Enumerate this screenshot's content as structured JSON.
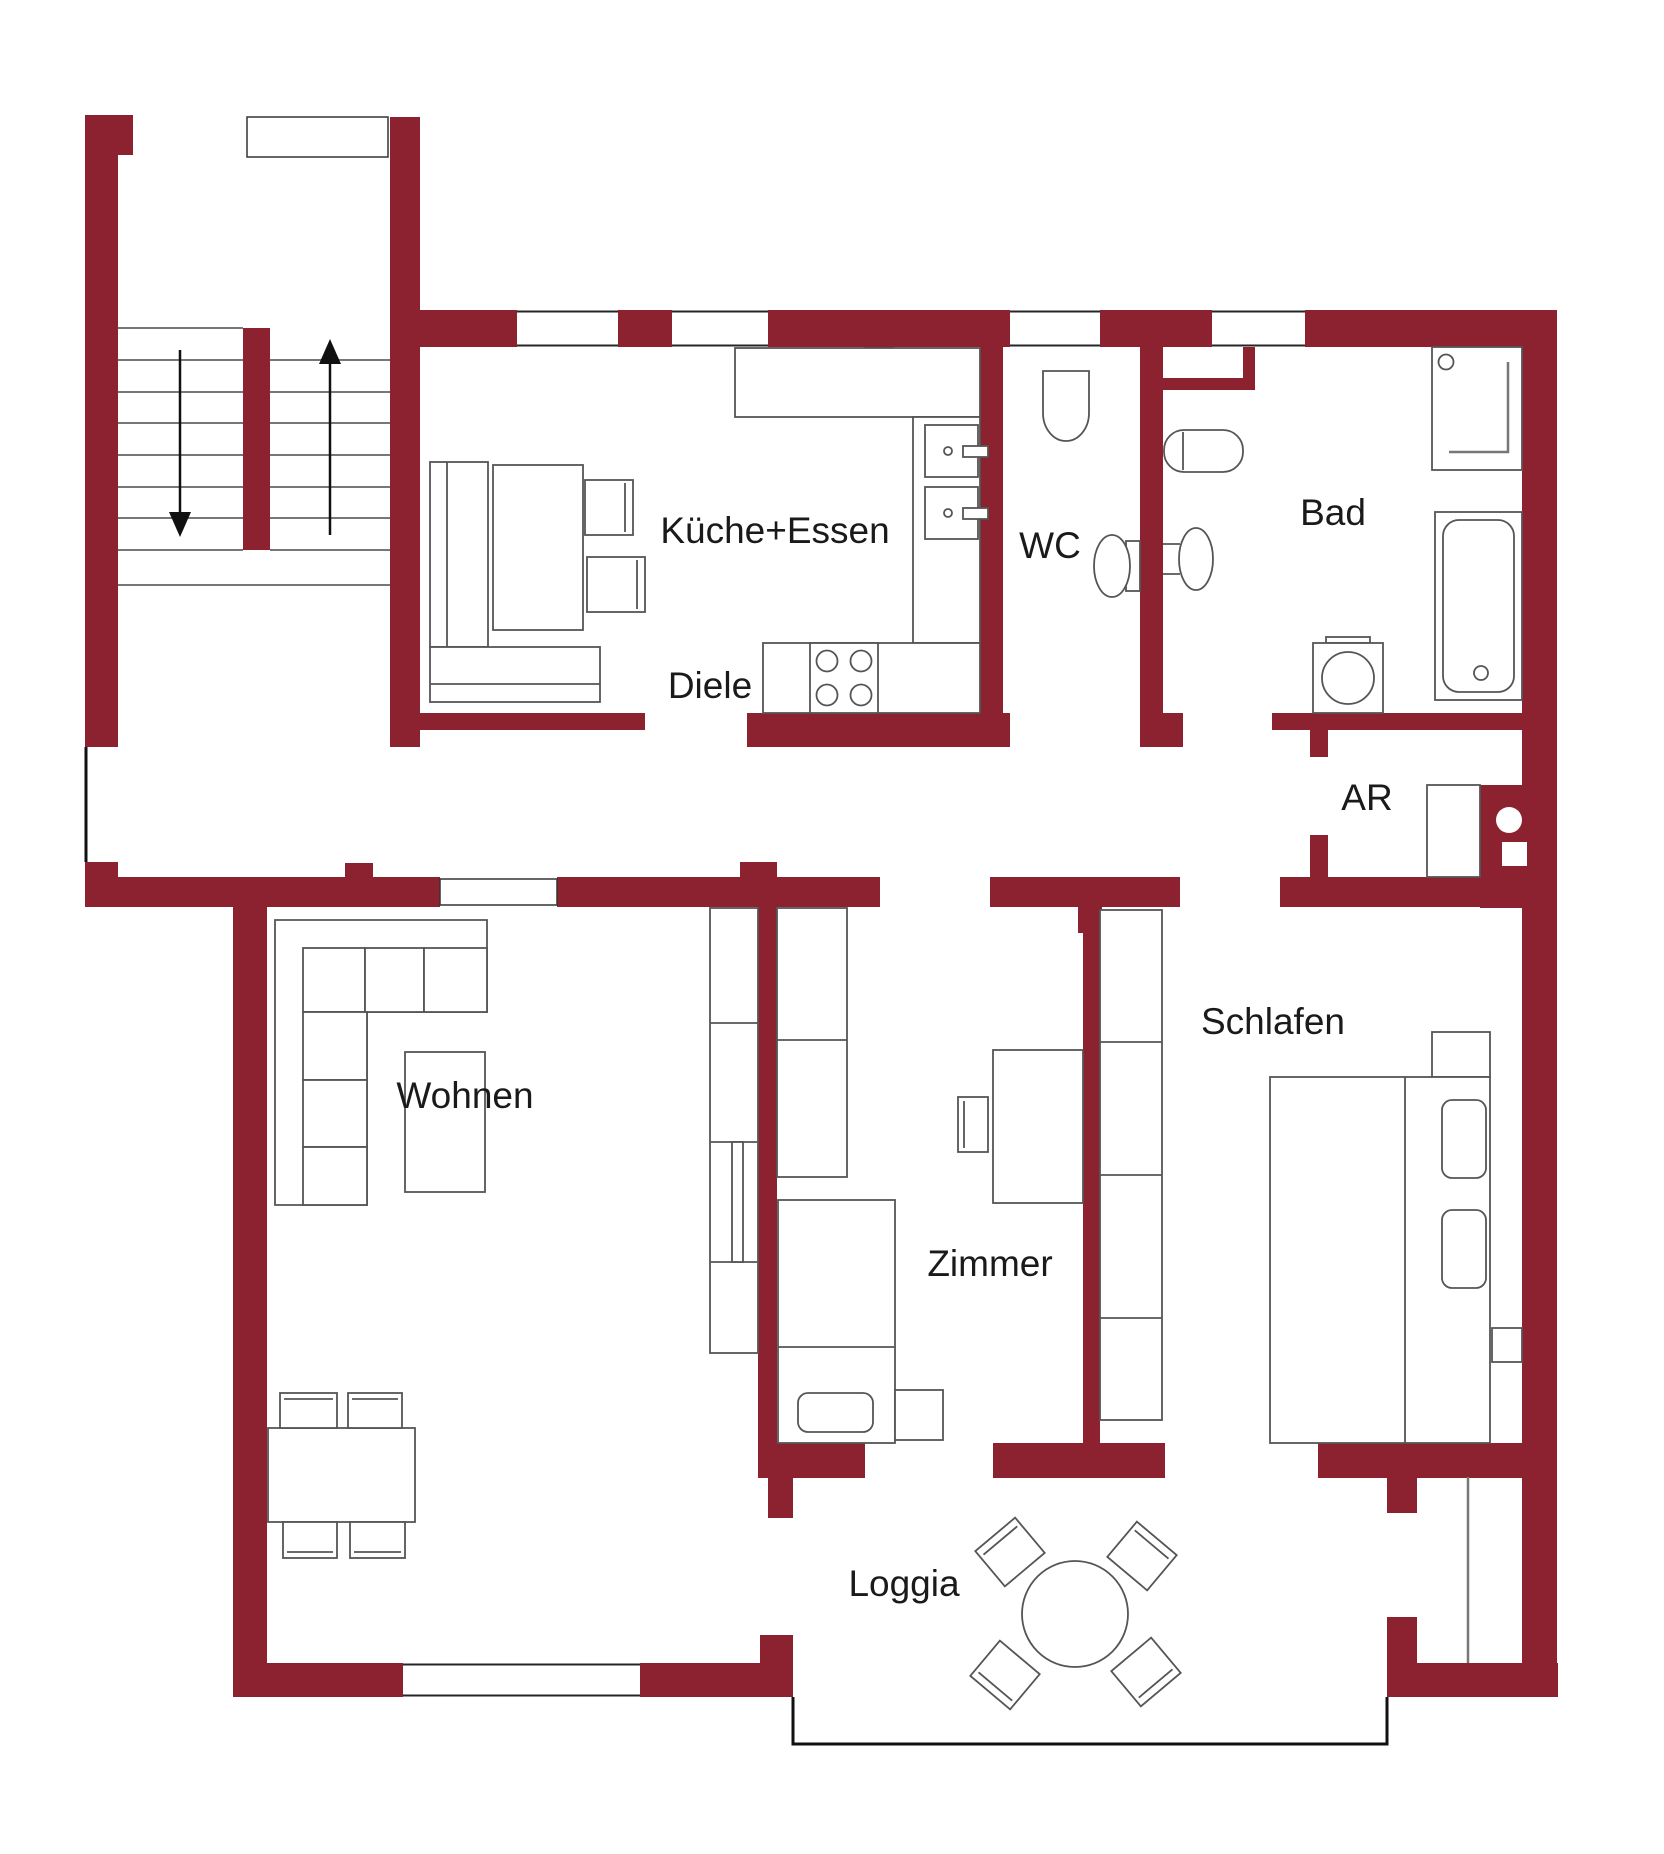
{
  "title": "Apartment floor plan",
  "colors": {
    "wall": "#8C2130",
    "furniture_line": "#555555",
    "tread_line": "#777777",
    "window_line": "#262626",
    "outline": "#111111",
    "text": "#1a1a1a",
    "background": "#ffffff"
  },
  "rooms": [
    {
      "id": "kueche",
      "label": "Küche+Essen",
      "x": 775,
      "y": 533
    },
    {
      "id": "wc",
      "label": "WC",
      "x": 1050,
      "y": 548
    },
    {
      "id": "bad",
      "label": "Bad",
      "x": 1333,
      "y": 515
    },
    {
      "id": "diele",
      "label": "Diele",
      "x": 710,
      "y": 688
    },
    {
      "id": "ar",
      "label": "AR",
      "x": 1367,
      "y": 800
    },
    {
      "id": "wohnen",
      "label": "Wohnen",
      "x": 465,
      "y": 1098
    },
    {
      "id": "zimmer",
      "label": "Zimmer",
      "x": 990,
      "y": 1266
    },
    {
      "id": "schlafen",
      "label": "Schlafen",
      "x": 1273,
      "y": 1024
    },
    {
      "id": "loggia",
      "label": "Loggia",
      "x": 904,
      "y": 1586
    }
  ],
  "label_font_size": 37,
  "walls": [
    [
      85,
      115,
      33,
      632
    ],
    [
      118,
      115,
      15,
      40
    ],
    [
      85,
      862,
      33,
      15
    ],
    [
      390,
      117,
      30,
      630
    ],
    [
      243,
      328,
      27,
      222
    ],
    [
      390,
      310,
      127,
      37
    ],
    [
      618,
      310,
      54,
      37
    ],
    [
      768,
      310,
      242,
      37
    ],
    [
      1100,
      310,
      112,
      37
    ],
    [
      1305,
      310,
      252,
      37
    ],
    [
      1522,
      347,
      35,
      1350
    ],
    [
      864,
      347,
      30,
      18
    ],
    [
      980,
      347,
      23,
      366
    ],
    [
      1140,
      347,
      23,
      366
    ],
    [
      1243,
      347,
      12,
      43
    ],
    [
      1140,
      378,
      115,
      12
    ],
    [
      420,
      713,
      225,
      17
    ],
    [
      747,
      713,
      263,
      34
    ],
    [
      1140,
      713,
      43,
      34
    ],
    [
      1272,
      713,
      251,
      17
    ],
    [
      85,
      877,
      355,
      30
    ],
    [
      557,
      877,
      323,
      30
    ],
    [
      990,
      877,
      190,
      30
    ],
    [
      1280,
      877,
      243,
      30
    ],
    [
      345,
      863,
      28,
      14
    ],
    [
      740,
      862,
      37,
      15
    ],
    [
      1078,
      907,
      24,
      26
    ],
    [
      1310,
      730,
      18,
      27
    ],
    [
      1310,
      835,
      18,
      42
    ],
    [
      1480,
      785,
      43,
      123
    ],
    [
      758,
      877,
      19,
      601
    ],
    [
      1083,
      877,
      17,
      601
    ],
    [
      233,
      907,
      34,
      790
    ],
    [
      758,
      1443,
      107,
      35
    ],
    [
      993,
      1443,
      172,
      35
    ],
    [
      1318,
      1443,
      205,
      35
    ],
    [
      768,
      1478,
      25,
      40
    ],
    [
      1387,
      1477,
      30,
      36
    ],
    [
      233,
      1663,
      170,
      34
    ],
    [
      640,
      1663,
      153,
      34
    ],
    [
      760,
      1635,
      33,
      62
    ],
    [
      1387,
      1663,
      171,
      34
    ],
    [
      1387,
      1617,
      30,
      46
    ]
  ],
  "windows": [
    {
      "x": 517,
      "y": 310,
      "w": 101,
      "h": 37,
      "orient": "h"
    },
    {
      "x": 672,
      "y": 310,
      "w": 96,
      "h": 37,
      "orient": "h"
    },
    {
      "x": 1010,
      "y": 310,
      "w": 90,
      "h": 37,
      "orient": "h"
    },
    {
      "x": 1212,
      "y": 310,
      "w": 93,
      "h": 37,
      "orient": "h"
    },
    {
      "x": 403,
      "y": 1663,
      "w": 237,
      "h": 34,
      "orient": "h"
    }
  ],
  "door_panels": [
    {
      "n": "stairwell-door-recess",
      "x": 247,
      "y": 117,
      "w": 141,
      "h": 40
    },
    {
      "n": "wohnen-door-opening",
      "x": 440,
      "y": 879,
      "w": 117,
      "h": 26
    }
  ],
  "outline_lines": [
    {
      "n": "entry-door-line",
      "pts": "86,747 86,862",
      "w": 3
    },
    {
      "n": "loggia-edge-line",
      "pts": "793,1697 793,1744 1387,1744 1387,1697",
      "w": 3
    }
  ],
  "misc_lines": [
    {
      "n": "bay-window-glass",
      "x1": 1468,
      "y1": 1477,
      "x2": 1468,
      "y2": 1663,
      "w": 2.5,
      "c": "#777777"
    }
  ],
  "stairs": {
    "left_flight": {
      "x1": 118,
      "x2": 243,
      "ys": [
        328,
        360,
        392,
        423,
        455,
        487,
        518,
        550
      ]
    },
    "right_flight": {
      "x1": 270,
      "x2": 390,
      "ys": [
        360,
        392,
        423,
        455,
        487,
        518,
        550
      ]
    },
    "landing_line": {
      "x1": 118,
      "x2": 390,
      "y": 585
    },
    "arrows": [
      {
        "n": "stairs-down-arrow",
        "x": 180,
        "y1": 350,
        "y2": 512,
        "dir": "down"
      },
      {
        "n": "stairs-up-arrow",
        "x": 330,
        "y1": 535,
        "y2": 364,
        "dir": "up"
      }
    ]
  },
  "furniture": [
    {
      "n": "kitchen-counter-top",
      "t": "r",
      "x": 735,
      "y": 348,
      "w": 245,
      "h": 69
    },
    {
      "n": "kitchen-counter-right",
      "t": "r",
      "x": 913,
      "y": 417,
      "w": 67,
      "h": 226
    },
    {
      "n": "kitchen-counter-bottom",
      "t": "r",
      "x": 763,
      "y": 643,
      "w": 217,
      "h": 70
    },
    {
      "n": "kitchen-stove",
      "t": "r",
      "x": 810,
      "y": 643,
      "w": 68,
      "h": 70
    },
    {
      "n": "stove-burner",
      "t": "c",
      "cx": 827,
      "cy": 661,
      "r": 10.5
    },
    {
      "n": "stove-burner",
      "t": "c",
      "cx": 861,
      "cy": 661,
      "r": 10.5
    },
    {
      "n": "stove-burner",
      "t": "c",
      "cx": 827,
      "cy": 695,
      "r": 10.5
    },
    {
      "n": "stove-burner",
      "t": "c",
      "cx": 861,
      "cy": 695,
      "r": 10.5
    },
    {
      "n": "kitchen-sink",
      "t": "r",
      "x": 925,
      "y": 425,
      "w": 53,
      "h": 52
    },
    {
      "n": "sink-drain",
      "t": "c",
      "cx": 948,
      "cy": 451,
      "r": 4
    },
    {
      "n": "sink-faucet",
      "t": "r",
      "x": 963,
      "y": 446,
      "w": 25,
      "h": 11
    },
    {
      "n": "kitchen-sink",
      "t": "r",
      "x": 925,
      "y": 487,
      "w": 53,
      "h": 52
    },
    {
      "n": "sink-drain",
      "t": "c",
      "cx": 948,
      "cy": 513,
      "r": 4
    },
    {
      "n": "sink-faucet",
      "t": "r",
      "x": 963,
      "y": 508,
      "w": 25,
      "h": 11
    },
    {
      "n": "kitchen-bench-vertical",
      "t": "r",
      "x": 430,
      "y": 462,
      "w": 58,
      "h": 185
    },
    {
      "n": "kitchen-bench-horizontal",
      "t": "r",
      "x": 430,
      "y": 647,
      "w": 170,
      "h": 55
    },
    {
      "n": "bench-back-line",
      "t": "l",
      "x1": 447,
      "y1": 462,
      "x2": 447,
      "y2": 647
    },
    {
      "n": "bench-back-line",
      "t": "l",
      "x1": 430,
      "y1": 684,
      "x2": 600,
      "y2": 684
    },
    {
      "n": "kitchen-table",
      "t": "r",
      "x": 493,
      "y": 465,
      "w": 90,
      "h": 165
    },
    {
      "n": "kitchen-chair",
      "t": "r",
      "x": 585,
      "y": 480,
      "w": 48,
      "h": 55
    },
    {
      "n": "chair-back-line",
      "t": "l",
      "x1": 625,
      "y1": 483,
      "x2": 625,
      "y2": 532
    },
    {
      "n": "kitchen-chair",
      "t": "r",
      "x": 587,
      "y": 557,
      "w": 58,
      "h": 55
    },
    {
      "n": "chair-back-line",
      "t": "l",
      "x1": 637,
      "y1": 560,
      "x2": 637,
      "y2": 609
    },
    {
      "n": "wc-sink",
      "t": "p",
      "d": "M1043,371 h46 v42 a23,28 0 0 1 -46,0 z"
    },
    {
      "n": "wc-toilet-tank",
      "t": "r",
      "x": 1126,
      "y": 541,
      "w": 14,
      "h": 50
    },
    {
      "n": "wc-toilet",
      "t": "e",
      "cx": 1112,
      "cy": 566,
      "rx": 18,
      "ry": 31
    },
    {
      "n": "bad-toilet",
      "t": "r",
      "x": 1164,
      "y": 430,
      "w": 79,
      "h": 42,
      "rx": 20
    },
    {
      "n": "bad-toilet-line",
      "t": "l",
      "x1": 1183,
      "y1": 432,
      "x2": 1183,
      "y2": 470
    },
    {
      "n": "bad-bidet-line",
      "t": "l",
      "x1": 1163,
      "y1": 544,
      "x2": 1180,
      "y2": 544
    },
    {
      "n": "bad-bidet-line",
      "t": "l",
      "x1": 1163,
      "y1": 574,
      "x2": 1180,
      "y2": 574
    },
    {
      "n": "bad-bidet",
      "t": "e",
      "cx": 1196,
      "cy": 559,
      "rx": 17,
      "ry": 31
    },
    {
      "n": "shower",
      "t": "r",
      "x": 1432,
      "y": 347,
      "w": 90,
      "h": 123
    },
    {
      "n": "shower-head",
      "t": "c",
      "cx": 1446,
      "cy": 362,
      "r": 7.5
    },
    {
      "n": "shower-glass",
      "t": "pl",
      "pts": "1508,362 1508,452 1449,452",
      "c": "#777777",
      "w": 2.5
    },
    {
      "n": "bathtub-zone",
      "t": "r",
      "x": 1435,
      "y": 512,
      "w": 87,
      "h": 188
    },
    {
      "n": "bathtub",
      "t": "r",
      "x": 1443,
      "y": 520,
      "w": 71,
      "h": 172,
      "rx": 16
    },
    {
      "n": "bathtub-drain",
      "t": "c",
      "cx": 1481,
      "cy": 673,
      "r": 7
    },
    {
      "n": "washing-machine-lid",
      "t": "r",
      "x": 1326,
      "y": 637,
      "w": 44,
      "h": 6
    },
    {
      "n": "washing-machine",
      "t": "r",
      "x": 1313,
      "y": 643,
      "w": 70,
      "h": 70
    },
    {
      "n": "washing-machine-drum",
      "t": "c",
      "cx": 1348,
      "cy": 678,
      "r": 26
    },
    {
      "n": "ar-cabinet",
      "t": "r",
      "x": 1427,
      "y": 785,
      "w": 53,
      "h": 92
    },
    {
      "n": "shaft-pipe",
      "t": "c",
      "cx": 1509,
      "cy": 820,
      "r": 13,
      "ns": 1
    },
    {
      "n": "shaft-duct",
      "t": "r",
      "x": 1502,
      "y": 842,
      "w": 25,
      "h": 24,
      "ns": 1
    },
    {
      "n": "sofa-outline",
      "t": "p",
      "d": "M275,920 H487 V1012 H367 V1205 H275 Z"
    },
    {
      "n": "sofa-cushion",
      "t": "r",
      "x": 303,
      "y": 948,
      "w": 62,
      "h": 64
    },
    {
      "n": "sofa-cushion",
      "t": "r",
      "x": 365,
      "y": 948,
      "w": 59,
      "h": 64
    },
    {
      "n": "sofa-cushion",
      "t": "r",
      "x": 424,
      "y": 948,
      "w": 63,
      "h": 64
    },
    {
      "n": "sofa-cushion",
      "t": "r",
      "x": 303,
      "y": 1012,
      "w": 64,
      "h": 68
    },
    {
      "n": "sofa-cushion",
      "t": "r",
      "x": 303,
      "y": 1080,
      "w": 64,
      "h": 67
    },
    {
      "n": "sofa-cushion",
      "t": "r",
      "x": 303,
      "y": 1147,
      "w": 64,
      "h": 58
    },
    {
      "n": "coffee-table",
      "t": "r",
      "x": 405,
      "y": 1052,
      "w": 80,
      "h": 140
    },
    {
      "n": "wohnen-shelf",
      "t": "r",
      "x": 710,
      "y": 908,
      "w": 48,
      "h": 445
    },
    {
      "n": "shelf-divider",
      "t": "l",
      "x1": 710,
      "y1": 1023,
      "x2": 758,
      "y2": 1023
    },
    {
      "n": "shelf-divider",
      "t": "l",
      "x1": 710,
      "y1": 1142,
      "x2": 758,
      "y2": 1142
    },
    {
      "n": "shelf-divider",
      "t": "l",
      "x1": 710,
      "y1": 1262,
      "x2": 758,
      "y2": 1262
    },
    {
      "n": "shelf-inner",
      "t": "r",
      "x": 732,
      "y": 1142,
      "w": 11,
      "h": 120
    },
    {
      "n": "dining-table",
      "t": "r",
      "x": 268,
      "y": 1428,
      "w": 147,
      "h": 94
    },
    {
      "n": "dining-chair",
      "t": "r",
      "x": 280,
      "y": 1393,
      "w": 57,
      "h": 35
    },
    {
      "n": "chair-back-line",
      "t": "l",
      "x1": 284,
      "y1": 1399,
      "x2": 333,
      "y2": 1399
    },
    {
      "n": "dining-chair",
      "t": "r",
      "x": 348,
      "y": 1393,
      "w": 54,
      "h": 35
    },
    {
      "n": "chair-back-line",
      "t": "l",
      "x1": 352,
      "y1": 1399,
      "x2": 398,
      "y2": 1399
    },
    {
      "n": "dining-chair",
      "t": "r",
      "x": 283,
      "y": 1522,
      "w": 54,
      "h": 36
    },
    {
      "n": "chair-back-line",
      "t": "l",
      "x1": 287,
      "y1": 1552,
      "x2": 333,
      "y2": 1552
    },
    {
      "n": "dining-chair",
      "t": "r",
      "x": 350,
      "y": 1522,
      "w": 55,
      "h": 36
    },
    {
      "n": "chair-back-line",
      "t": "l",
      "x1": 354,
      "y1": 1552,
      "x2": 401,
      "y2": 1552
    },
    {
      "n": "zimmer-wardrobe",
      "t": "r",
      "x": 777,
      "y": 908,
      "w": 70,
      "h": 269
    },
    {
      "n": "wardrobe-divider",
      "t": "l",
      "x1": 777,
      "y1": 1040,
      "x2": 847,
      "y2": 1040
    },
    {
      "n": "zimmer-bed",
      "t": "r",
      "x": 778,
      "y": 1200,
      "w": 117,
      "h": 243
    },
    {
      "n": "bed-line",
      "t": "l",
      "x1": 778,
      "y1": 1347,
      "x2": 895,
      "y2": 1347
    },
    {
      "n": "zimmer-pillow",
      "t": "r",
      "x": 798,
      "y": 1393,
      "w": 75,
      "h": 39,
      "rx": 10
    },
    {
      "n": "zimmer-nightstand",
      "t": "r",
      "x": 895,
      "y": 1390,
      "w": 48,
      "h": 50
    },
    {
      "n": "zimmer-desk",
      "t": "r",
      "x": 993,
      "y": 1050,
      "w": 90,
      "h": 153
    },
    {
      "n": "desk-chair",
      "t": "r",
      "x": 958,
      "y": 1097,
      "w": 30,
      "h": 55
    },
    {
      "n": "chair-back-line",
      "t": "l",
      "x1": 964,
      "y1": 1101,
      "x2": 964,
      "y2": 1148
    },
    {
      "n": "schlafen-wardrobe",
      "t": "r",
      "x": 1100,
      "y": 910,
      "w": 62,
      "h": 510
    },
    {
      "n": "wardrobe-divider",
      "t": "l",
      "x1": 1100,
      "y1": 1042,
      "x2": 1162,
      "y2": 1042
    },
    {
      "n": "wardrobe-divider",
      "t": "l",
      "x1": 1100,
      "y1": 1175,
      "x2": 1162,
      "y2": 1175
    },
    {
      "n": "wardrobe-divider",
      "t": "l",
      "x1": 1100,
      "y1": 1318,
      "x2": 1162,
      "y2": 1318
    },
    {
      "n": "schlafen-nightstand",
      "t": "r",
      "x": 1432,
      "y": 1032,
      "w": 58,
      "h": 45
    },
    {
      "n": "schlafen-bed",
      "t": "r",
      "x": 1270,
      "y": 1077,
      "w": 220,
      "h": 366
    },
    {
      "n": "bed-line",
      "t": "l",
      "x1": 1405,
      "y1": 1077,
      "x2": 1405,
      "y2": 1443
    },
    {
      "n": "schlafen-pillow",
      "t": "r",
      "x": 1442,
      "y": 1100,
      "w": 44,
      "h": 78,
      "rx": 10
    },
    {
      "n": "schlafen-pillow",
      "t": "r",
      "x": 1442,
      "y": 1210,
      "w": 44,
      "h": 78,
      "rx": 10
    },
    {
      "n": "schlafen-shelf",
      "t": "r",
      "x": 1492,
      "y": 1328,
      "w": 30,
      "h": 34
    },
    {
      "n": "loggia-table",
      "t": "c",
      "cx": 1075,
      "cy": 1614,
      "r": 53
    },
    {
      "n": "loggia-chair",
      "t": "rr",
      "cx": 1010,
      "cy": 1552,
      "w": 52,
      "h": 46,
      "deg": -40
    },
    {
      "n": "loggia-chair",
      "t": "rr",
      "cx": 1142,
      "cy": 1556,
      "w": 52,
      "h": 46,
      "deg": 40
    },
    {
      "n": "loggia-chair",
      "t": "rr",
      "cx": 1005,
      "cy": 1675,
      "w": 52,
      "h": 46,
      "deg": -140
    },
    {
      "n": "loggia-chair",
      "t": "rr",
      "cx": 1146,
      "cy": 1672,
      "w": 52,
      "h": 46,
      "deg": 140
    }
  ]
}
